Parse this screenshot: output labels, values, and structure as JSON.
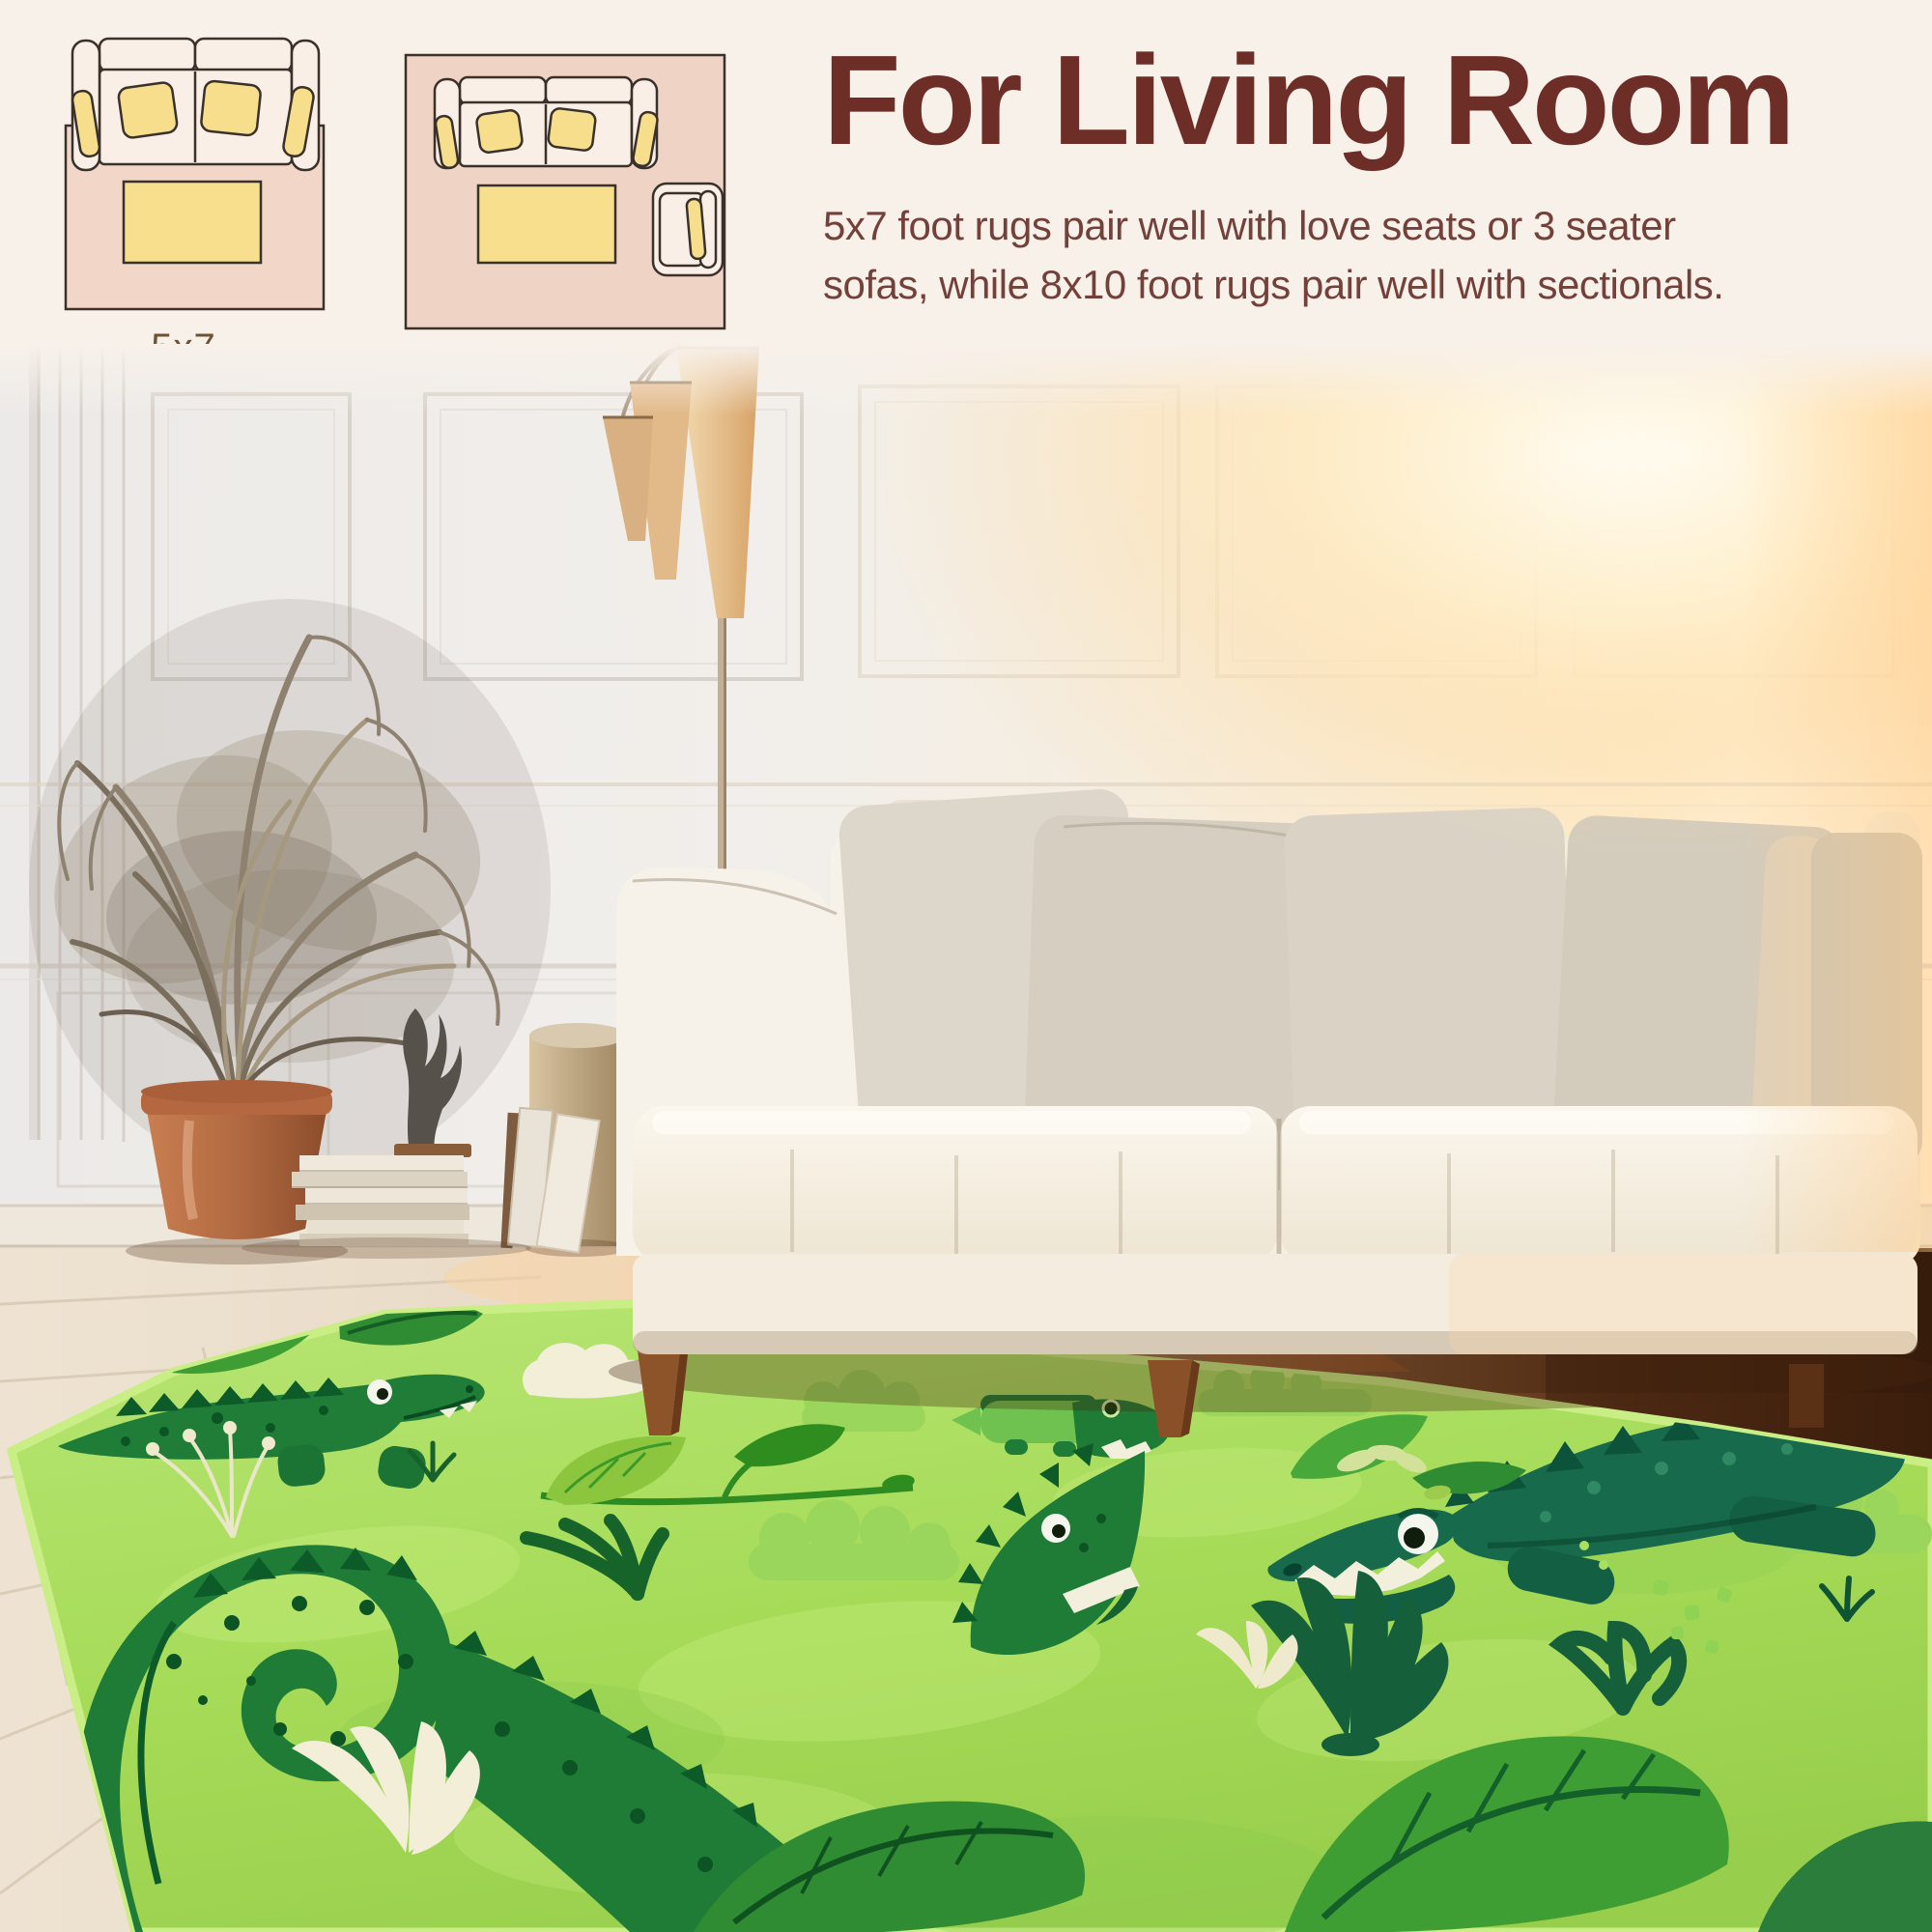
{
  "size_guide": {
    "heading": "For Living Room",
    "description_line1": "5x7 foot rugs pair well with love seats or 3 seater",
    "description_line2": "sofas, while 8x10 foot rugs pair well with sectionals.",
    "diagrams": [
      {
        "label": "5x7",
        "items": [
          "loveseat-sofa",
          "coffee-table"
        ]
      },
      {
        "label": "8x10",
        "items": [
          "three-seat-sofa",
          "coffee-table",
          "armchair"
        ]
      }
    ]
  },
  "colors": {
    "background_cream": "#f8f1ea",
    "heading_text": "#6d2e27",
    "body_text": "#74413a",
    "diagram_label_brown": "#6d5233",
    "diagram_rug_pink": "#f2d6c8",
    "diagram_sofa_cream": "#f9efe7",
    "diagram_pillow_yellow": "#f7de8d",
    "diagram_outline": "#3a312b",
    "rug_green": "#a6db58",
    "rug_binding_lime": "#c9ee85",
    "crocodile_green": "#1f7d38",
    "crocodile_dark_green": "#0d5b28",
    "crocodile_teal": "#176a4b",
    "leaf_green": "#3f9e33",
    "rug_accent_cream": "#f2eed8",
    "sofa_cream": "#f6f1e8",
    "pillow_greige": "#d6cfc2",
    "floor_wood_light": "#ece2d4",
    "floor_wood_dark": "#47250f",
    "pot_terracotta": "#b26a41",
    "lamp_shade_tan": "#ecc697"
  }
}
